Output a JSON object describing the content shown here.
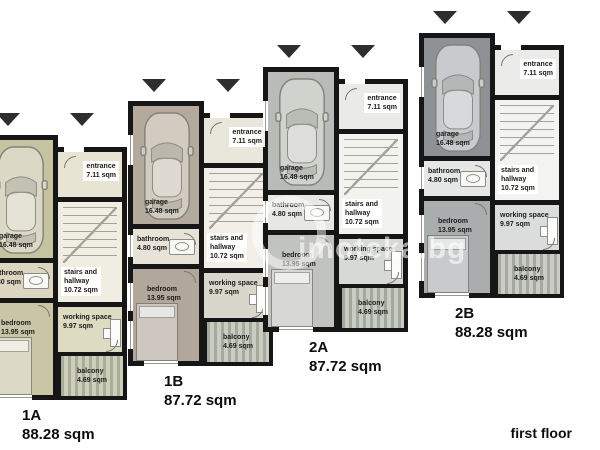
{
  "page": {
    "floor_label": "first floor",
    "watermark": "imoteka.bg"
  },
  "palette": {
    "wall": "#161616",
    "unit_1a_floor": "#c6c3a0",
    "unit_1b_floor": "#b3aa9d",
    "unit_2a_floor": "#b8bbb7",
    "unit_2b_floor": "#8e9294",
    "balcony_stripe": "#a5aa9d",
    "arrow": "#2e2e2e"
  },
  "units": [
    {
      "id": "1A",
      "area": "88.28 sqm",
      "rooms": {
        "garage": "garage\n16.48 sqm",
        "entrance": "entrance\n7.11 sqm",
        "stairs_hallway": "stairs and\nhallway\n10.72 sqm",
        "bathroom": "bathroom\n4.80 sqm",
        "bedroom": "bedroom\n13.95 sqm",
        "working_space": "working space\n9.97 sqm",
        "balcony": "balcony\n4.69 sqm"
      }
    },
    {
      "id": "1B",
      "area": "87.72 sqm",
      "rooms": {
        "garage": "garage\n16.48 sqm",
        "entrance": "entrance\n7.11 sqm",
        "stairs_hallway": "stairs and\nhallway\n10.72 sqm",
        "bathroom": "bathroom\n4.80 sqm",
        "bedroom": "bedroom\n13.95 sqm",
        "working_space": "working space\n9.97 sqm",
        "balcony": "balcony\n4.69 sqm"
      }
    },
    {
      "id": "2A",
      "area": "87.72 sqm",
      "rooms": {
        "garage": "garage\n16.48 sqm",
        "entrance": "entrance\n7.11 sqm",
        "stairs_hallway": "stairs and\nhallway\n10.72 sqm",
        "bathroom": "bathroom\n4.80 sqm",
        "bedroom": "bedroom\n13.95 sqm",
        "working_space": "working space\n9.97 sqm",
        "balcony": "balcony\n4.69 sqm"
      }
    },
    {
      "id": "2B",
      "area": "88.28 sqm",
      "rooms": {
        "garage": "garage\n16.48 sqm",
        "entrance": "entrance\n7.11 sqm",
        "stairs_hallway": "stairs and\nhallway\n10.72 sqm",
        "bathroom": "bathroom\n4.80 sqm",
        "bedroom": "bedroom\n13.95 sqm",
        "working_space": "working space\n9.97 sqm",
        "balcony": "balcony\n4.69 sqm"
      }
    }
  ]
}
